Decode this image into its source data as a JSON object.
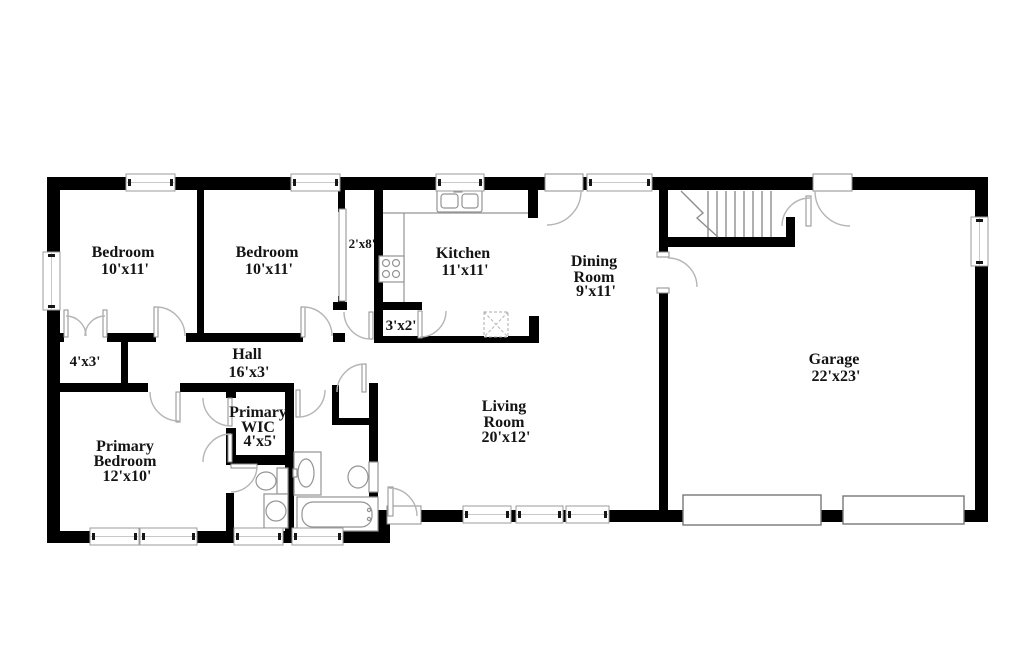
{
  "colors": {
    "wall": "#000000",
    "line": "#b5b5b5",
    "text": "#141414",
    "bg": "#ffffff"
  },
  "rooms": {
    "bedroom_1": {
      "name": "Bedroom",
      "dims": "10'x11'"
    },
    "bedroom_2": {
      "name": "Bedroom",
      "dims": "10'x11'"
    },
    "kitchen": {
      "name": "Kitchen",
      "dims": "11'x11'"
    },
    "dining_room": {
      "name": "Dining",
      "name2": "Room",
      "dims": "9'x11'"
    },
    "living_room": {
      "name": "Living",
      "name2": "Room",
      "dims": "20'x12'"
    },
    "garage": {
      "name": "Garage",
      "dims": "22'x23'"
    },
    "hall": {
      "name": "Hall",
      "dims": "16'x3'"
    },
    "primary_bedroom": {
      "name": "Primary",
      "name2": "Bedroom",
      "dims": "12'x10'"
    },
    "primary_wic": {
      "name": "Primary",
      "name2": "WIC",
      "dims": "4'x5'"
    },
    "closet_bedroom1": {
      "dims": "4'x3'"
    },
    "closet_kitchen": {
      "dims": "3'x2'"
    },
    "closet_bedroom2": {
      "dims": "2'x8'"
    }
  }
}
